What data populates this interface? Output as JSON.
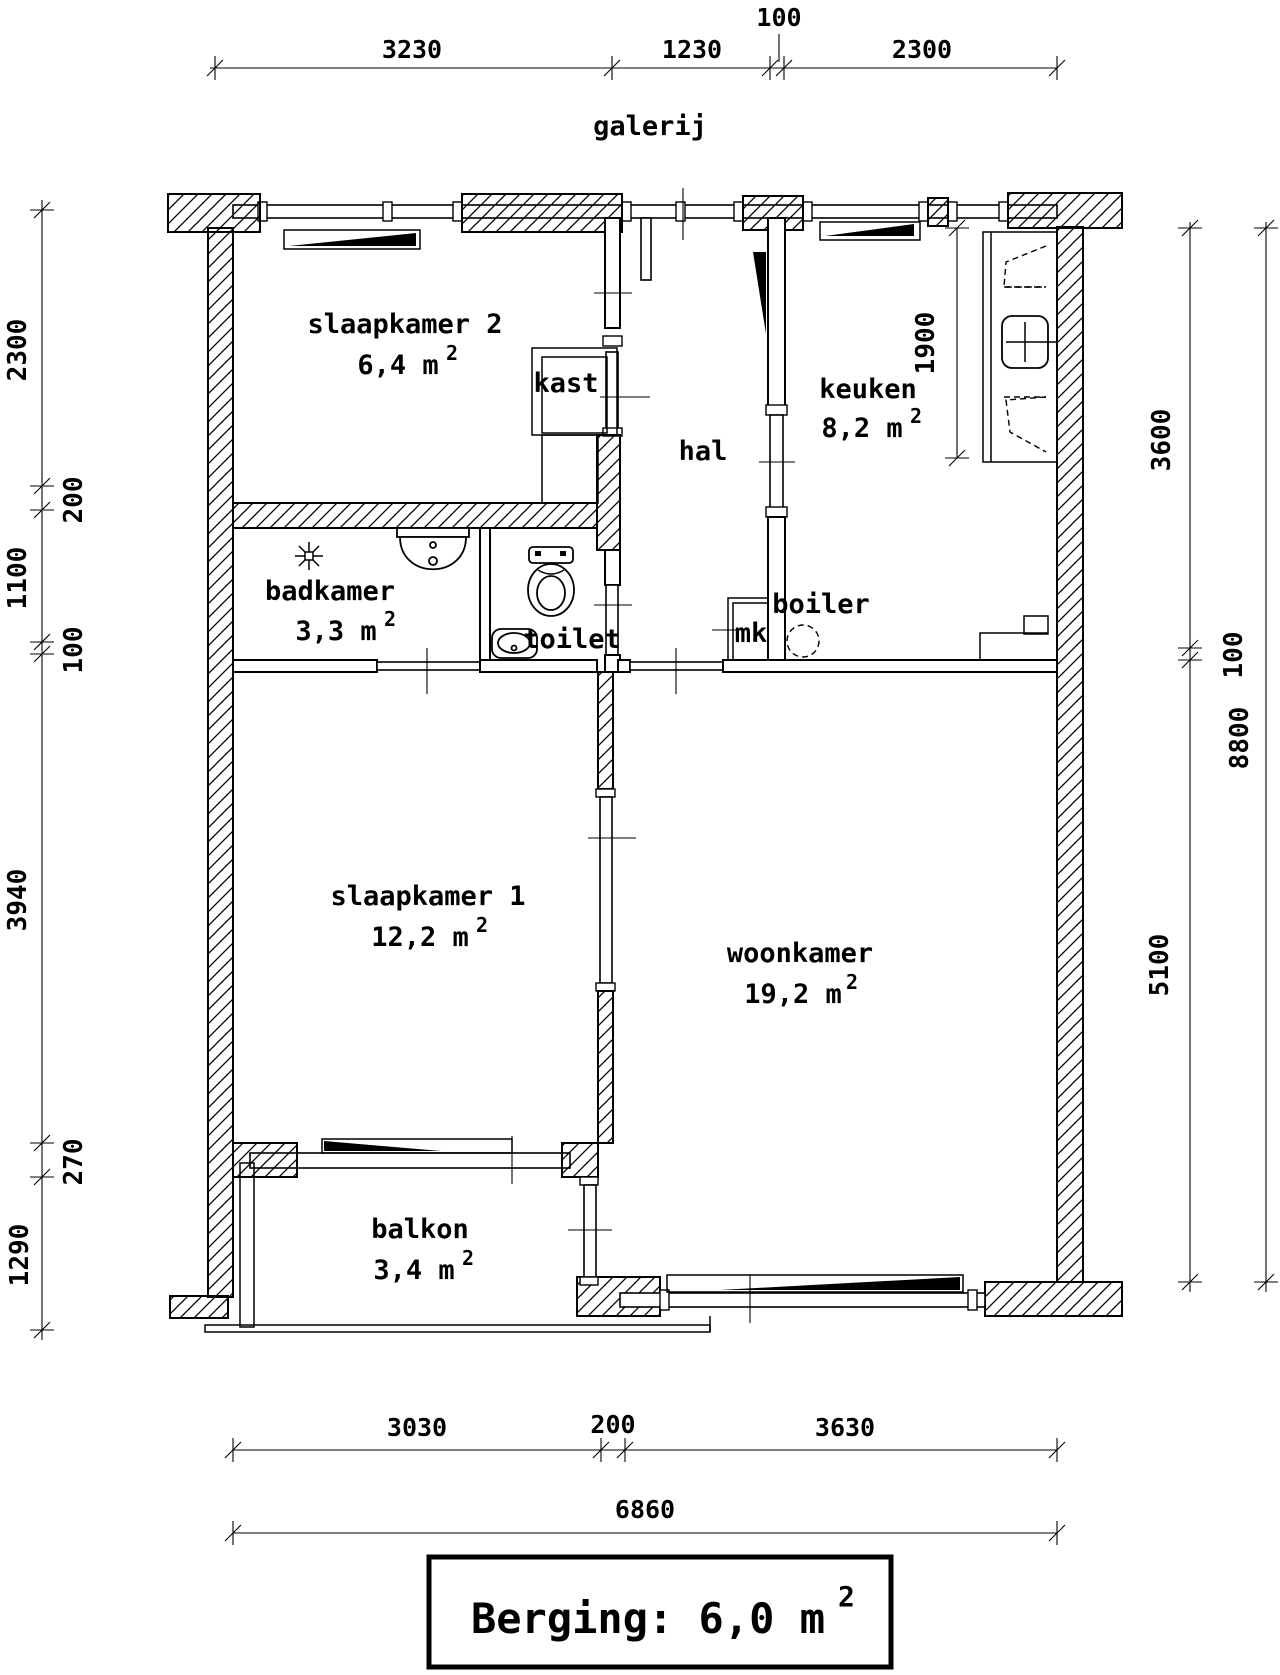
{
  "plan": {
    "ink": "#000000",
    "paper": "#ffffff",
    "sup_char": "2",
    "labels": {
      "galerij": "galerij"
    },
    "rooms": [
      {
        "id": "slaapkamer2",
        "name": "slaapkamer 2",
        "area": "6,4 m"
      },
      {
        "id": "kast",
        "name": "kast"
      },
      {
        "id": "hal",
        "name": "hal"
      },
      {
        "id": "keuken",
        "name": "keuken",
        "area": "8,2 m"
      },
      {
        "id": "badkamer",
        "name": "badkamer",
        "area": "3,3 m"
      },
      {
        "id": "toilet",
        "name": "toilet"
      },
      {
        "id": "mk",
        "name": "mk"
      },
      {
        "id": "boiler",
        "name": "boiler"
      },
      {
        "id": "slaapkamer1",
        "name": "slaapkamer 1",
        "area": "12,2 m"
      },
      {
        "id": "woonkamer",
        "name": "woonkamer",
        "area": "19,2 m"
      },
      {
        "id": "balkon",
        "name": "balkon",
        "area": "3,4 m"
      }
    ],
    "dims": {
      "top": [
        "3230",
        "1230",
        "100",
        "2300"
      ],
      "left": [
        "2300",
        "200",
        "1100",
        "100",
        "3940",
        "270",
        "1290"
      ],
      "right_inner": [
        "3600",
        "100",
        "5100"
      ],
      "right_outer": [
        "8800"
      ],
      "kitchen_counter": "1900",
      "bottom": [
        "3030",
        "200",
        "3630"
      ],
      "bottom_total": "6860"
    },
    "storage": {
      "label": "Berging: 6,0 m"
    }
  }
}
